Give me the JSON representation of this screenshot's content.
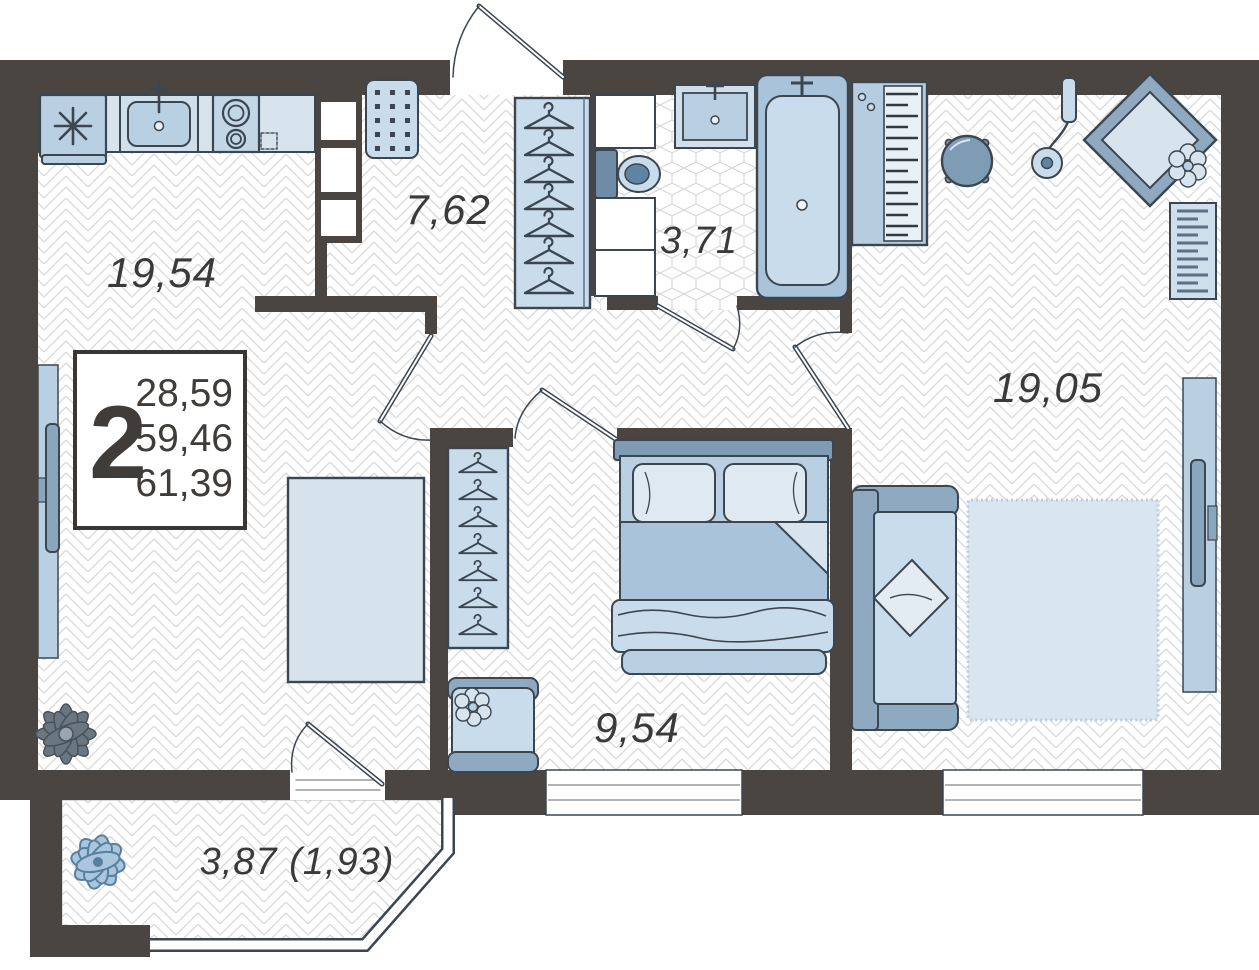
{
  "plan": {
    "legend": {
      "room_count": "2",
      "areas": [
        "28,59",
        "59,46",
        "61,39"
      ]
    },
    "rooms": [
      {
        "id": "kitchen-living",
        "label": "19,54",
        "furniture": [
          "refrigerator-icon",
          "kitchen-sink-icon",
          "stove-icon",
          "countertop",
          "tv-icon",
          "plant-icon",
          "dining-table-icon",
          "chair-icon"
        ]
      },
      {
        "id": "hallway",
        "label": "7,62",
        "furniture": [
          "doormat-icon",
          "wardrobe-hangers-icon"
        ]
      },
      {
        "id": "bathroom",
        "label": "3,71",
        "furniture": [
          "washbasin-icon",
          "toilet-icon",
          "bathtub-icon"
        ]
      },
      {
        "id": "bedroom",
        "label": "9,54",
        "furniture": [
          "double-bed-icon",
          "wardrobe-hangers-icon",
          "armchair-icon"
        ]
      },
      {
        "id": "living-room",
        "label": "19,05",
        "furniture": [
          "piano-icon",
          "pouf-icon",
          "floor-lamp-icon",
          "lounge-chair-icon",
          "radiator-icon",
          "sofa-icon",
          "rug-icon",
          "tv-icon"
        ]
      },
      {
        "id": "balcony",
        "label": "3,87 (1,93)",
        "furniture": [
          "plant-icon"
        ]
      }
    ],
    "colors": {
      "wall": "#4a4540",
      "furniture_light": "#c9dceb",
      "furniture_medium": "#8fa9c0",
      "outline": "#3c4650",
      "floor_hatch": "#d9d9d9"
    }
  }
}
